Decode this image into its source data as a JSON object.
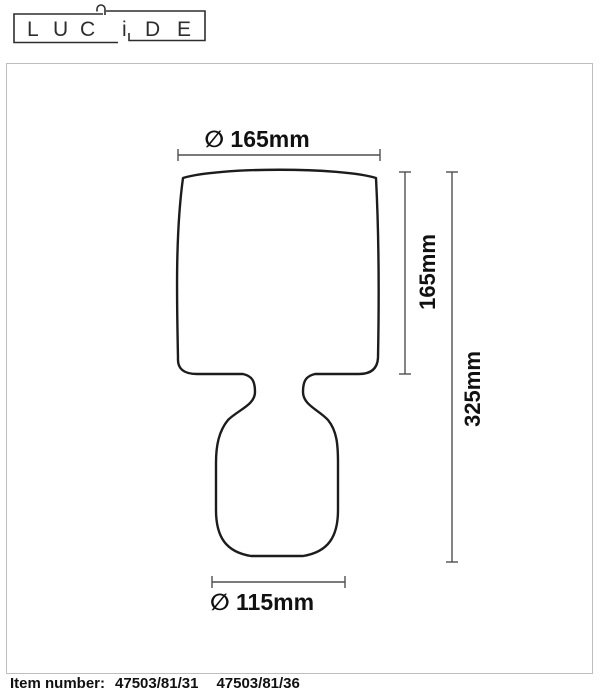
{
  "brand": {
    "letters": [
      "L",
      "U",
      "C",
      "i",
      "D",
      "E"
    ]
  },
  "dimensions": {
    "top_diameter": "∅ 165mm",
    "shade_height": "165mm",
    "total_height": "325mm",
    "base_diameter": "∅ 115mm"
  },
  "footer": {
    "label": "Item number:",
    "items": [
      "47503/81/31",
      "47503/81/36"
    ]
  },
  "colors": {
    "outline": "#1c1c1c",
    "dimension": "#4f4f4f",
    "border": "#bdbdbd",
    "text": "#111111",
    "logo": "#2e2e2e"
  }
}
